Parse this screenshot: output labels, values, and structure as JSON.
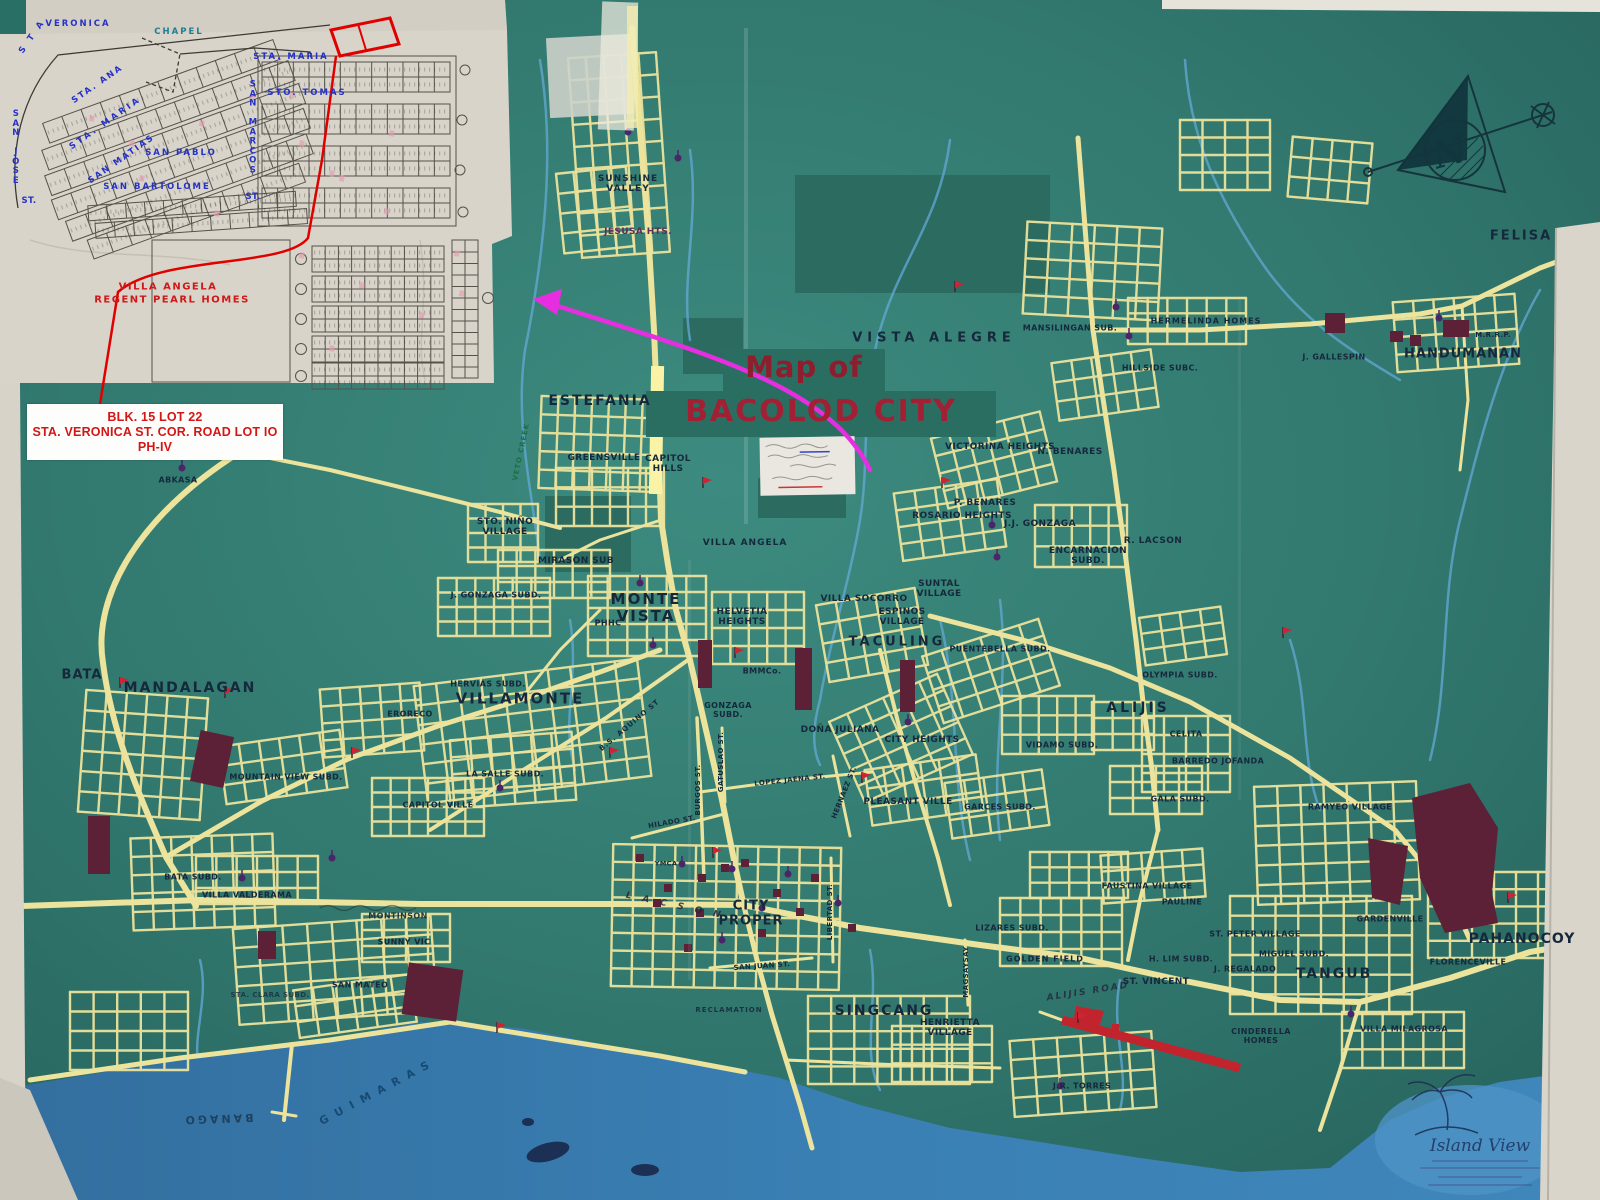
{
  "title": {
    "line1": "Map of",
    "line2": "BACOLOD CITY"
  },
  "callout": {
    "line1": "BLK. 15 LOT 22",
    "line2": "STA. VERONICA ST. COR. ROAD LOT IO",
    "line3": "PH-IV"
  },
  "logo": {
    "name": "Island View"
  },
  "colors": {
    "map_green": "#337b72",
    "road_yellow": "#ece39c",
    "water_blue": "#3a80b4",
    "river_blue": "#63a9d6",
    "maroon": "#5c2136",
    "runway_red": "#c2242e",
    "title_red": "#a32034",
    "label_navy": "#16283c",
    "inset_blue": "#2531c8",
    "inset_red": "#d01818",
    "magenta_arrow": "#e62ee0",
    "paper": "#d9d4c9"
  },
  "inset": {
    "subdivision_line1": "VILLA ANGELA",
    "subdivision_line2": "REGENT PEARL HOMES",
    "labels": [
      {
        "t": "VERONICA",
        "x": 78,
        "y": 25,
        "ls": 2
      },
      {
        "t": "CHAPEL",
        "x": 179,
        "y": 33,
        "c": "#1d7f96",
        "ls": 2
      },
      {
        "t": "STA. MARIA",
        "x": 291,
        "y": 58,
        "ls": 2
      },
      {
        "t": "STO. TOMAS",
        "x": 307,
        "y": 94,
        "ls": 2
      },
      {
        "t": "SAN PABLO",
        "x": 181,
        "y": 154,
        "ls": 2
      },
      {
        "t": "SAN BARTOLOME",
        "x": 157,
        "y": 188,
        "ls": 2
      },
      {
        "t": "SAN JOSE",
        "x": 16,
        "y": 148,
        "st": 1
      },
      {
        "t": "ST.",
        "x": 29,
        "y": 202
      },
      {
        "t": "S T A",
        "x": 33,
        "y": 37,
        "r": -55,
        "ls": 3
      },
      {
        "t": "STA. ANA",
        "x": 98,
        "y": 85,
        "r": -35,
        "ls": 2
      },
      {
        "t": "STA. MARIA",
        "x": 106,
        "y": 124,
        "r": -35,
        "ls": 3
      },
      {
        "t": "SAN MATIAS",
        "x": 122,
        "y": 160,
        "r": -35,
        "ls": 2
      },
      {
        "t": "SAN MARCOS",
        "x": 253,
        "y": 128,
        "st": 1
      },
      {
        "t": "ST.",
        "x": 253,
        "y": 198
      },
      {
        "t": "VILLA ANGELA",
        "x": 168,
        "y": 287,
        "c": "#d01818",
        "s": 10,
        "ls": 1.5
      },
      {
        "t": "REGENT PEARL HOMES",
        "x": 172,
        "y": 300,
        "c": "#d01818",
        "s": 10,
        "ls": 1.5
      }
    ]
  },
  "map_labels": [
    {
      "t": "SUNSHINE\nVALLEY",
      "x": 628,
      "y": 184,
      "ls": 1
    },
    {
      "t": "JESUSA HTS.",
      "x": 638,
      "y": 232,
      "c": "#5d2f55"
    },
    {
      "t": "VISTA ALEGRE",
      "x": 934,
      "y": 339,
      "s": 13,
      "ls": 5
    },
    {
      "t": "MANSILINGAN SUB.",
      "x": 1070,
      "y": 329,
      "s": 8
    },
    {
      "t": "HERMELINDA HOMES",
      "x": 1206,
      "y": 322,
      "s": 8,
      "ls": 1
    },
    {
      "t": "HILLSIDE SUBC.",
      "x": 1160,
      "y": 369,
      "s": 8
    },
    {
      "t": "J. GALLESPIN",
      "x": 1334,
      "y": 358,
      "s": 8
    },
    {
      "t": "HANDUMANAN",
      "x": 1463,
      "y": 355,
      "s": 13,
      "ls": 1
    },
    {
      "t": "M.R.R.P.",
      "x": 1493,
      "y": 336,
      "s": 7
    },
    {
      "t": "FELISA",
      "x": 1521,
      "y": 237,
      "s": 13,
      "ls": 2
    },
    {
      "t": "ESTEFANIA",
      "x": 600,
      "y": 402,
      "s": 14,
      "ls": 2
    },
    {
      "t": "GREENSVILLE",
      "x": 604,
      "y": 458
    },
    {
      "t": "CAPITOL\nHILLS",
      "x": 668,
      "y": 464
    },
    {
      "t": "VETO CREEK",
      "x": 522,
      "y": 452,
      "r": -78,
      "c": "#1f6e46",
      "s": 7,
      "ls": 1
    },
    {
      "t": "STO. NIÑO\nVILLAGE",
      "x": 505,
      "y": 527
    },
    {
      "t": "MIRASON SUB",
      "x": 576,
      "y": 561
    },
    {
      "t": "VILLA ANGELA",
      "x": 745,
      "y": 543,
      "ls": 1
    },
    {
      "t": "VICTORINA HEIGHTS",
      "x": 1000,
      "y": 447
    },
    {
      "t": "N. BENARES",
      "x": 1070,
      "y": 452
    },
    {
      "t": "P. BENARES",
      "x": 985,
      "y": 503
    },
    {
      "t": "ROSARIO HEIGHTS",
      "x": 962,
      "y": 516
    },
    {
      "t": "J.J. GONZAGA",
      "x": 1040,
      "y": 524
    },
    {
      "t": "ENCARNACION\nSUBD.",
      "x": 1088,
      "y": 556
    },
    {
      "t": "R. LACSON",
      "x": 1153,
      "y": 541
    },
    {
      "t": "SUNTAL\nVILLAGE",
      "x": 939,
      "y": 589
    },
    {
      "t": "VILLA SOCORRO",
      "x": 864,
      "y": 599
    },
    {
      "t": "ESPINOS\nVILLAGE",
      "x": 902,
      "y": 617
    },
    {
      "t": "TACULING",
      "x": 897,
      "y": 643,
      "s": 13,
      "ls": 3
    },
    {
      "t": "PUENTEBELLA SUBD.",
      "x": 1000,
      "y": 650,
      "s": 8
    },
    {
      "t": "OLYMPIA SUBD.",
      "x": 1180,
      "y": 676,
      "s": 8
    },
    {
      "t": "ALIJIS",
      "x": 1138,
      "y": 709,
      "s": 14,
      "ls": 3
    },
    {
      "t": "CELITA",
      "x": 1186,
      "y": 735,
      "s": 8
    },
    {
      "t": "BARREDO JOFANDA",
      "x": 1218,
      "y": 762,
      "s": 8
    },
    {
      "t": "VIDAMO SUBD.",
      "x": 1062,
      "y": 746,
      "s": 8
    },
    {
      "t": "GALA SUBD.",
      "x": 1180,
      "y": 800,
      "s": 8
    },
    {
      "t": "J. GONZAGA SUBD.",
      "x": 496,
      "y": 596,
      "s": 8
    },
    {
      "t": "MONTE\nVISTA",
      "x": 646,
      "y": 608,
      "s": 15,
      "ls": 2
    },
    {
      "t": "PHHC",
      "x": 608,
      "y": 624,
      "s": 8
    },
    {
      "t": "HELVETIA\nHEIGHTS",
      "x": 742,
      "y": 617
    },
    {
      "t": "BMMCo.",
      "x": 762,
      "y": 672,
      "s": 8
    },
    {
      "t": "GONZAGA\nSUBD.",
      "x": 728,
      "y": 711,
      "s": 8
    },
    {
      "t": "DOÑA JULIANA",
      "x": 840,
      "y": 730
    },
    {
      "t": "CITY HEIGHTS",
      "x": 922,
      "y": 740
    },
    {
      "t": "BATA",
      "x": 82,
      "y": 676,
      "s": 13,
      "ls": 1
    },
    {
      "t": "MANDALAGAN",
      "x": 190,
      "y": 689,
      "s": 14,
      "ls": 2
    },
    {
      "t": "HERVIAS SUBD.",
      "x": 488,
      "y": 685,
      "s": 8
    },
    {
      "t": "VILLAMONTE",
      "x": 520,
      "y": 699,
      "s": 15,
      "ls": 2
    },
    {
      "t": "ERORECO",
      "x": 410,
      "y": 715,
      "s": 8
    },
    {
      "t": "MOUNTAIN VIEW SUBD.",
      "x": 286,
      "y": 778,
      "s": 8
    },
    {
      "t": "LA SALLE SUBD.",
      "x": 505,
      "y": 775,
      "s": 8
    },
    {
      "t": "PLEASANT VILLE",
      "x": 908,
      "y": 802
    },
    {
      "t": "GARCES SUBD.",
      "x": 1000,
      "y": 808,
      "s": 8
    },
    {
      "t": "CAPITOL VILLE",
      "x": 438,
      "y": 806,
      "s": 8
    },
    {
      "t": "BATA SUBD.",
      "x": 193,
      "y": 878,
      "s": 8
    },
    {
      "t": "VILLA VALDERAMA",
      "x": 247,
      "y": 896,
      "s": 8
    },
    {
      "t": "CITY\nPROPER",
      "x": 751,
      "y": 914,
      "s": 13,
      "ls": 1
    },
    {
      "t": "YMCA",
      "x": 666,
      "y": 864,
      "s": 6.5
    },
    {
      "t": "LIZARES SUBD.",
      "x": 1012,
      "y": 929,
      "s": 8
    },
    {
      "t": "GOLDEN FIELD",
      "x": 1045,
      "y": 960,
      "s": 8,
      "ls": 1
    },
    {
      "t": "FAUSTINA VILLAGE",
      "x": 1147,
      "y": 887,
      "s": 8
    },
    {
      "t": "PAULINE",
      "x": 1182,
      "y": 903,
      "s": 8
    },
    {
      "t": "ST. PETER VILLAGE",
      "x": 1255,
      "y": 935,
      "s": 8
    },
    {
      "t": "MIGUEL SUBD.",
      "x": 1294,
      "y": 955,
      "s": 8
    },
    {
      "t": "J. REGALADO",
      "x": 1245,
      "y": 970,
      "s": 8
    },
    {
      "t": "H. LIM SUBD.",
      "x": 1181,
      "y": 960,
      "s": 8
    },
    {
      "t": "ST. VINCENT",
      "x": 1156,
      "y": 982
    },
    {
      "t": "GARDENVILLE",
      "x": 1390,
      "y": 920,
      "s": 8
    },
    {
      "t": "PAHANOCOY",
      "x": 1522,
      "y": 940,
      "s": 14,
      "ls": 1
    },
    {
      "t": "FLORENCEVILLE",
      "x": 1468,
      "y": 963,
      "s": 8
    },
    {
      "t": "TANGUB",
      "x": 1334,
      "y": 975,
      "s": 14,
      "ls": 2
    },
    {
      "t": "RAMYEO VILLAGE",
      "x": 1350,
      "y": 808,
      "s": 8
    },
    {
      "t": "SINGCANG",
      "x": 884,
      "y": 1012,
      "s": 14,
      "ls": 2
    },
    {
      "t": "HENRIETTA\nVILLAGE",
      "x": 950,
      "y": 1028
    },
    {
      "t": "RECLAMATION",
      "x": 729,
      "y": 1011,
      "s": 7,
      "ls": 1,
      "o": 0.85
    },
    {
      "t": "CINDERELLA\nHOMES",
      "x": 1261,
      "y": 1037,
      "s": 8
    },
    {
      "t": "VILLA MILAGROSA",
      "x": 1404,
      "y": 1030,
      "s": 8
    },
    {
      "t": "J.R. TORRES",
      "x": 1082,
      "y": 1087,
      "s": 8
    },
    {
      "t": "SAN MATEO",
      "x": 360,
      "y": 986,
      "s": 8
    },
    {
      "t": "STA. CLARA SUBD.",
      "x": 270,
      "y": 996,
      "s": 7,
      "o": 0.75
    },
    {
      "t": "MONTINSON",
      "x": 398,
      "y": 917,
      "s": 8,
      "o": 0.9
    },
    {
      "t": "SUNNY VIC",
      "x": 404,
      "y": 943,
      "s": 8
    },
    {
      "t": "ABKASA",
      "x": 178,
      "y": 481,
      "s": 8
    },
    {
      "t": "BANAGO",
      "x": 218,
      "y": 1118,
      "r": 178,
      "c": "#1c3a52",
      "s": 11,
      "ls": 3,
      "o": 0.85
    },
    {
      "t": "GUIMARAS",
      "x": 378,
      "y": 1092,
      "r": -28,
      "c": "#14466e",
      "s": 11,
      "ls": 8,
      "o": 0.9
    },
    {
      "t": "B.S. AQUINO ST",
      "x": 630,
      "y": 726,
      "r": -40,
      "s": 7,
      "ls": 1
    },
    {
      "t": "BURGOS ST.",
      "x": 699,
      "y": 790,
      "r": -90,
      "s": 7
    },
    {
      "t": "GATUSLAO ST.",
      "x": 722,
      "y": 762,
      "r": -90,
      "s": 7
    },
    {
      "t": "LOPEZ JAENA ST.",
      "x": 790,
      "y": 781,
      "r": -6,
      "s": 7
    },
    {
      "t": "HILADO ST.",
      "x": 672,
      "y": 823,
      "r": -10,
      "s": 7
    },
    {
      "t": "HERNAEZ ST.",
      "x": 845,
      "y": 793,
      "r": -68,
      "s": 7
    },
    {
      "t": "LIBERTAD ST.",
      "x": 831,
      "y": 912,
      "r": -90,
      "s": 7
    },
    {
      "t": "SAN JUAN ST.",
      "x": 762,
      "y": 967,
      "r": -4,
      "s": 7
    },
    {
      "t": "MAGSAYSAY",
      "x": 967,
      "y": 972,
      "r": -90,
      "s": 7
    },
    {
      "t": "L A C S O N",
      "x": 675,
      "y": 906,
      "r": 12,
      "s": 9,
      "i": 1,
      "c": "#22263a",
      "ls": 4,
      "o": 0.85
    },
    {
      "t": "ALIJIS ROAD",
      "x": 1088,
      "y": 992,
      "r": -9,
      "s": 9,
      "i": 1,
      "c": "#22263a",
      "ls": 2,
      "o": 0.8
    },
    {
      "t": "N",
      "x": 1450,
      "y": 153,
      "s": 36,
      "c": "#12363e",
      "r": -15,
      "f": "serif",
      "i": 1
    }
  ]
}
